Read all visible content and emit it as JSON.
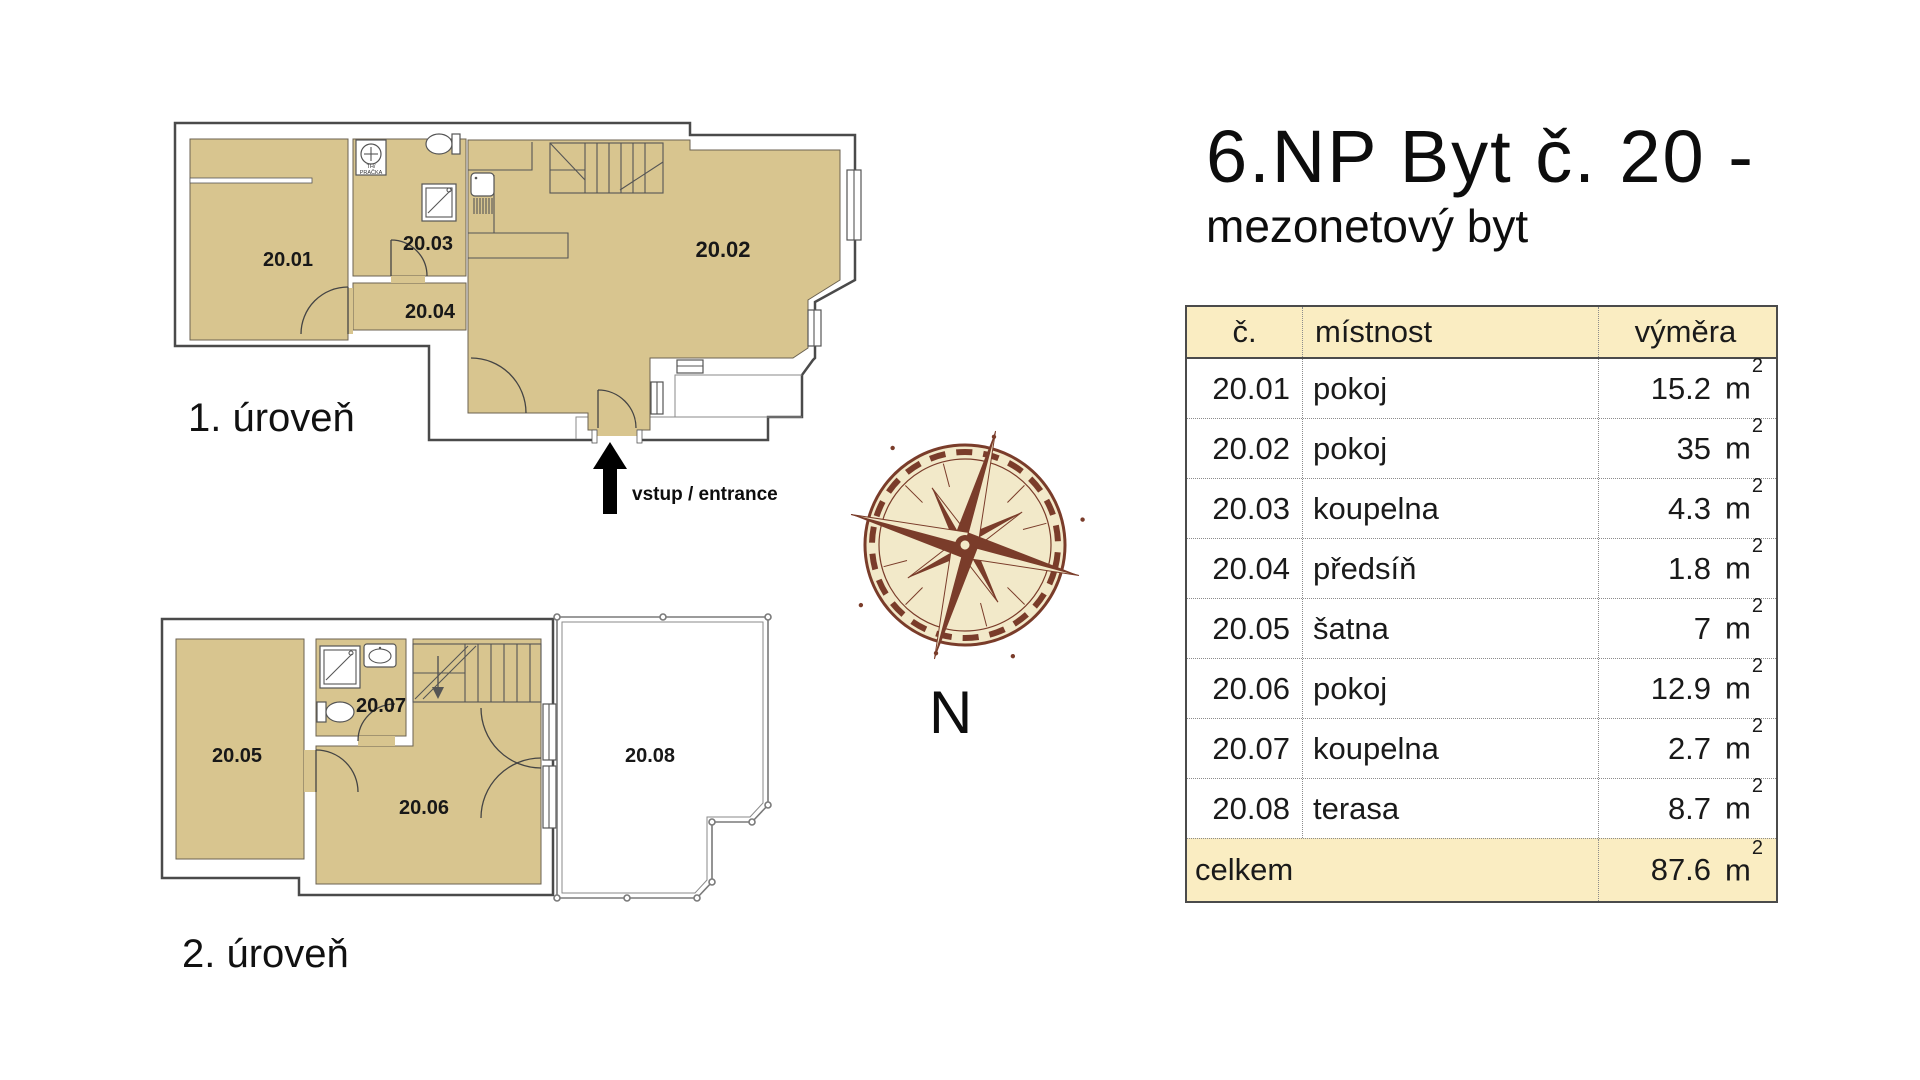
{
  "header": {
    "title": "6.NP Byt č. 20 -",
    "subtitle": "mezonetový byt"
  },
  "plan": {
    "level1_label": "1. úroveň",
    "level2_label": "2. úroveň",
    "entrance_label": "vstup / entrance",
    "compass_label": "N",
    "washer_line1": "TH/",
    "washer_line2": "PRAČKA",
    "rooms": {
      "r01": "20.01",
      "r02": "20.02",
      "r03": "20.03",
      "r04": "20.04",
      "r05": "20.05",
      "r06": "20.06",
      "r07": "20.07",
      "r08": "20.08"
    }
  },
  "table": {
    "headers": [
      "č.",
      "místnost",
      "výměra"
    ],
    "unit": "m",
    "unit_exp": "2",
    "rows": [
      {
        "no": "20.01",
        "room": "pokoj",
        "area": "15.2"
      },
      {
        "no": "20.02",
        "room": "pokoj",
        "area": "35"
      },
      {
        "no": "20.03",
        "room": "koupelna",
        "area": "4.3"
      },
      {
        "no": "20.04",
        "room": "předsíň",
        "area": "1.8"
      },
      {
        "no": "20.05",
        "room": "šatna",
        "area": "7"
      },
      {
        "no": "20.06",
        "room": "pokoj",
        "area": "12.9"
      },
      {
        "no": "20.07",
        "room": "koupelna",
        "area": "2.7"
      },
      {
        "no": "20.08",
        "room": "terasa",
        "area": "8.7"
      }
    ],
    "footer": {
      "label": "celkem",
      "area": "87.6"
    }
  },
  "colors": {
    "room_fill": "#D8C58F",
    "table_header_bg": "#FAEDC2",
    "compass_brown": "#7A3C2A",
    "compass_cream": "#F2E9C9",
    "line": "#4a4a4a"
  }
}
